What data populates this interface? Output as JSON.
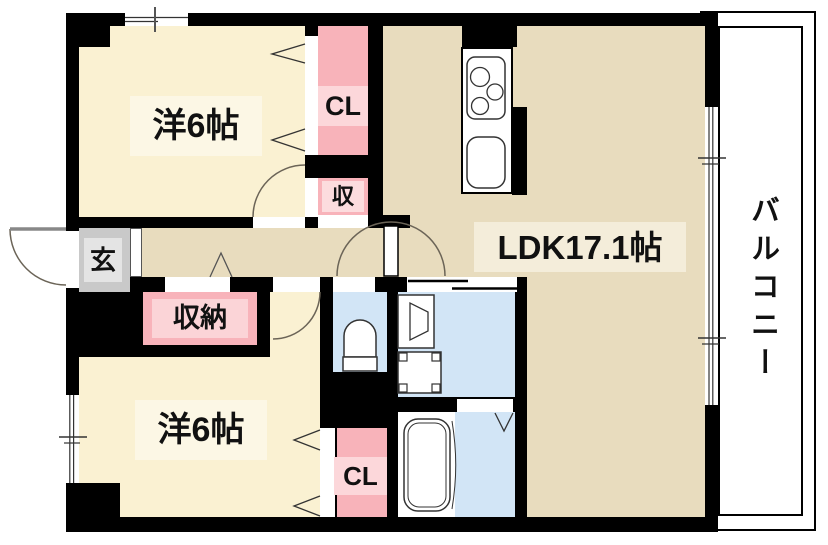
{
  "rooms": {
    "bedroom1": {
      "label": "洋6帖"
    },
    "bedroom2": {
      "label": "洋6帖"
    },
    "ldk": {
      "label": "LDK17.1帖"
    },
    "balcony": {
      "label": "バルコニー"
    },
    "entrance": {
      "label": "玄"
    },
    "closet1": {
      "label": "CL"
    },
    "closet2": {
      "label": "CL"
    },
    "storage": {
      "label": "収納"
    },
    "storage_small": {
      "label": "収"
    }
  },
  "fixtures": [
    "gas-stove-icon",
    "kitchen-sink-icon",
    "toilet-icon",
    "vanity-basin-icon",
    "washing-machine-pan-icon",
    "bathtub-icon",
    "entrance-door-swing-icon",
    "room-door-swing-icon",
    "folding-closet-door-icon",
    "sliding-door-icon",
    "sliding-window-icon"
  ],
  "colors": {
    "wall": "#000000",
    "bedroom_floor": "#FAF1D2",
    "ldk_floor": "#E8DCBE",
    "closet_fill": "#F8B3BA",
    "closet_label_bg": "#FCD7DA",
    "sanitary_floor": "#D2E5F6",
    "entrance_floor": "#C9C9C9",
    "balcony": "#FFFFFF",
    "cream_label_bg": "#FCF7E5",
    "ldk_label_bg": "#F4EDDA",
    "door_arc": "#6B6457"
  }
}
